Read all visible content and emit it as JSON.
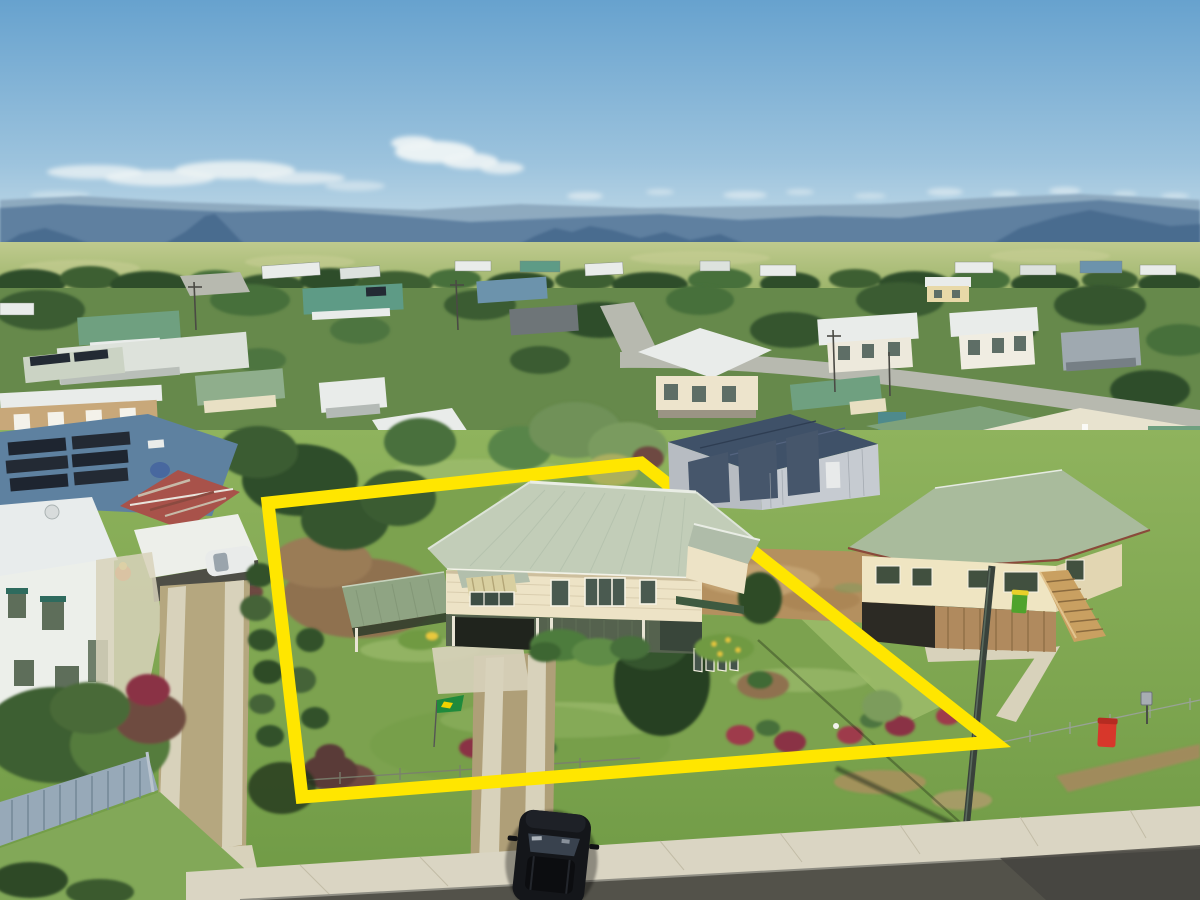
{
  "meta": {
    "title": "Aerial drone photograph of a residential property with highlighted lot boundary",
    "type": "photograph",
    "view": "oblique aerial, looking north over a small country town toward a mountain range"
  },
  "scene": {
    "sky": "clear blue sky with scattered wispy white clouds above a hazy blue mountain range",
    "background": "flat farmland and a tree line behind a low-density suburb of mixed white, grey, blue and green metal roofs",
    "subject_property": {
      "highlight": "thick yellow boundary outline drawn over the lot",
      "boundary_points": [
        [
          268,
          503
        ],
        [
          641,
          463
        ],
        [
          994,
          742
        ],
        [
          302,
          797
        ]
      ],
      "features": [
        "high-set Queenslander house with pale sage-green hip roof and cream weatherboard walls",
        "green skillion carport on left side",
        "double concrete strip driveway to street",
        "large lawn with garden beds and red shrubs",
        "small green-and-yellow flag in front yard"
      ]
    },
    "neighbours": {
      "left": "white two-storey house, rusty gable shed, white carport with white car, picket-fenced garden",
      "right": "cream Queenslander with green hip roof, timber stairs, green and red wheelie bins",
      "rear": "large grey shed with three roller doors on dirt apron; long green/cream roofed building beyond street"
    },
    "foreground": [
      "grass verge with power pole and its shadow",
      "concrete footpath",
      "asphalt road edge",
      "black SUV parked on driveway apron"
    ]
  },
  "colors": {
    "boundary_yellow": "#FFE600",
    "sky_top": "#67A2CE",
    "sky_horizon": "#CFE2EB",
    "cloud_white": "#EEF4F5",
    "mountain_far": "#8AA6BC",
    "mountain_main": "#5E80A0",
    "mountain_near": "#4A6C8F",
    "field_green": "#A9BA74",
    "treeline_dark": "#2F4E2B",
    "suburb_green": "#66894B",
    "street_grey": "#B7B9AF",
    "roof_white": "#E9ECEA",
    "roof_grey": "#9FA9B0",
    "roof_blue": "#6C93AC",
    "roof_slate": "#3F5168",
    "roof_teal": "#5E9B86",
    "roof_green": "#6FA080",
    "roof_rust": "#A8524A",
    "solar_panel": "#232A34",
    "subject_roof": "#C2CDB8",
    "subject_wall": "#EDE3C6",
    "subject_batten": "#55624E",
    "carport_green": "#8FA483",
    "shed_wall": "#C6CBD1",
    "shed_door": "#46566B",
    "neighbor_roof": "#A9BB9C",
    "neighbor_wall": "#EFE5C2",
    "stair_timber": "#C9A061",
    "lawn": "#7CA24F",
    "lawn_light": "#9FC06C",
    "lawn_dark": "#567C38",
    "mulch": "#8A6B4A",
    "dirt": "#B4905F",
    "concrete": "#D8D2BB",
    "sidewalk": "#DAD5C3",
    "road": "#53524A",
    "fence_blue": "#97A9B8",
    "pole_green": "#39423B",
    "bin_red": "#D7372B",
    "bin_green": "#4FA32C",
    "bin_lid_yellow": "#E8D02A",
    "flag_green": "#1F8A3C",
    "flag_yellow": "#F2D200",
    "car_black": "#14161A",
    "car_white": "#E9EBEA",
    "shrub_red": "#9E3B4C",
    "shrub_dark": "#2E4C28",
    "foliage_olive": "#7C9C5C"
  }
}
